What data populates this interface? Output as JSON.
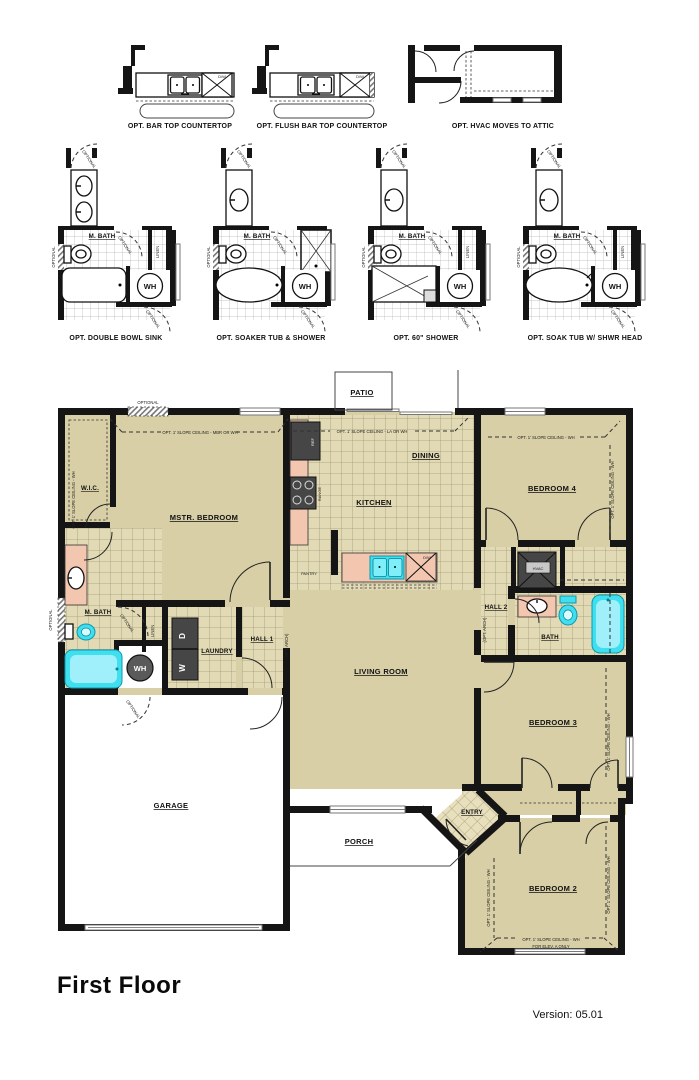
{
  "header_options": {
    "bar_top": "OPT. BAR TOP COUNTERTOP",
    "flush_bar_top": "OPT. FLUSH BAR TOP COUNTERTOP",
    "hvac_attic": "OPT. HVAC MOVES TO ATTIC"
  },
  "bath_options": {
    "double_bowl": "OPT. DOUBLE BOWL SINK",
    "soaker": "OPT. SOAKER TUB & SHOWER",
    "shower60": "OPT. 60\" SHOWER",
    "soak_shwr": "OPT. SOAK TUB W/ SHWR HEAD"
  },
  "labels": {
    "m_bath": "M. BATH",
    "wh": "WH",
    "linen": "LINEN",
    "optional": "OPTIONAL",
    "dw": "D/W",
    "opt_arch": "(OPT. ARCH)",
    "ref": "REF",
    "range": "RANGE",
    "hvac": "HVAC",
    "washer": "W",
    "dryer": "D",
    "pantry": "PANTRY"
  },
  "rooms": {
    "patio": "PATIO",
    "wic": "W.I.C.",
    "mstr_bedroom": "MSTR. BEDROOM",
    "dining": "DINING",
    "kitchen": "KITCHEN",
    "bedroom4": "BEDROOM 4",
    "hall2": "HALL 2",
    "bath": "BATH",
    "laundry": "LAUNDRY",
    "hall1": "HALL 1",
    "living": "LIVING ROOM",
    "bedroom3": "BEDROOM 3",
    "garage": "GARAGE",
    "porch": "PORCH",
    "entry": "ENTRY",
    "bedroom2": "BEDROOM 2"
  },
  "ceiling_notes": {
    "mbr": "OPT. 1' SLOPE CEILING - MBR OR WH",
    "la": "OPT. 1' SLOPE CEILING - LA OR WH",
    "wh": "OPT. 1' SLOPE CEILING - WH",
    "elev": "FOR ELEV. A ONLY"
  },
  "footer": {
    "title": "First Floor",
    "version": "Version: 05.01"
  },
  "colors": {
    "wall": "#151515",
    "room_fill": "#d8cfa6",
    "tile_fill": "#e2dab4",
    "tile_line": "#a1987a",
    "counter": "#f2c6af",
    "fixture_cyan": "#3fdff0",
    "appliance": "#464646"
  }
}
